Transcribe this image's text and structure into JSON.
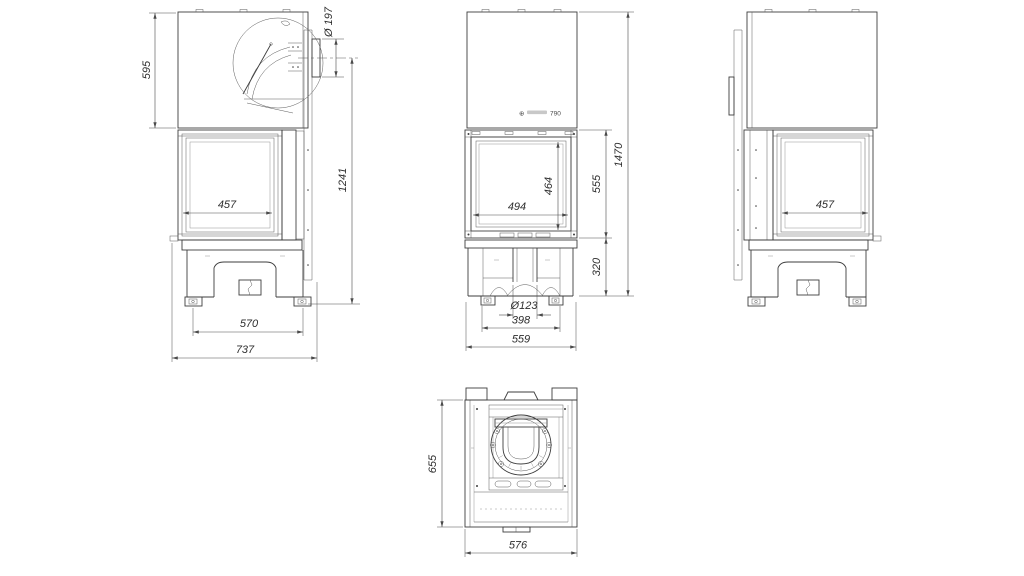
{
  "colors": {
    "line": "#3d3d3d",
    "dimension": "#4a4a4a",
    "text": "#2e2e2e",
    "background": "#ffffff"
  },
  "views": {
    "side_left": {
      "dims": {
        "hood_height": "595",
        "glass_depth": "457",
        "flue_diameter": "Ø 197",
        "flue_axis_height": "1241",
        "feet_span": "570",
        "total_depth": "737"
      }
    },
    "front": {
      "logo": {
        "mark": "⊕",
        "model": "790"
      },
      "dims": {
        "glass_width": "494",
        "glass_height": "464",
        "firebox_height": "555",
        "base_height": "320",
        "total_height": "1470",
        "air_inlet_diameter": "Ø123",
        "feet_span": "398",
        "body_width": "559"
      }
    },
    "side_right": {
      "dims": {
        "glass_depth": "457"
      }
    },
    "top": {
      "dims": {
        "depth": "655",
        "width": "576"
      }
    }
  }
}
